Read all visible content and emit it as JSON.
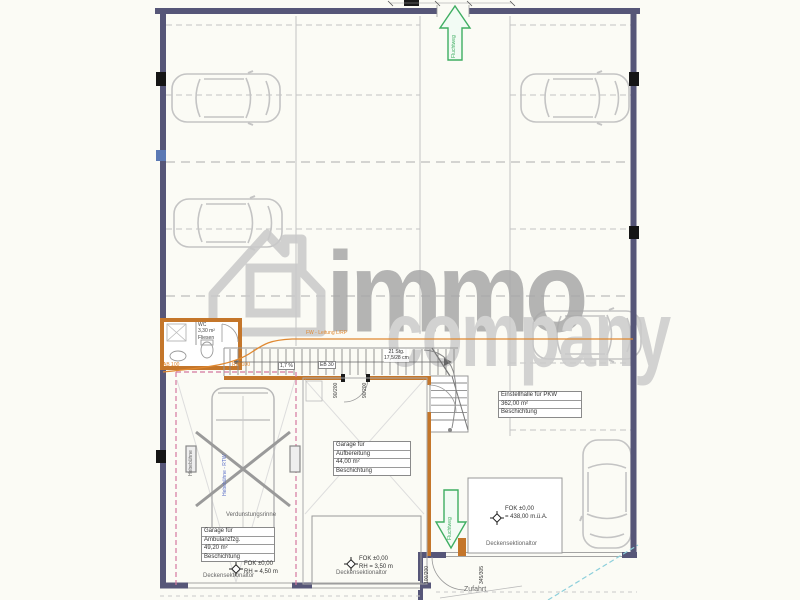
{
  "watermark": {
    "word_top": "immo",
    "word_bottom": "company"
  },
  "rooms": {
    "hall": {
      "l1": "Einstellhalle für PKW",
      "l2": "362,00 m²",
      "l3": "Beschichtung"
    },
    "garage_mid": {
      "l1": "Garage für",
      "l2": "Aufbereitung",
      "l3": "44,00 m²",
      "l4": "Beschichtung"
    },
    "garage_left": {
      "l1": "Garage für",
      "l2": "Ambulanzfzg.",
      "l3": "49,20 m²",
      "l4": "Beschichtung"
    },
    "wc": {
      "l1": "WC",
      "l2": "3,30 m²",
      "l3": "Fliesen"
    }
  },
  "levels": {
    "garage_left": {
      "l1": "FOK ±0,00",
      "l2": "RH = 4,50 m"
    },
    "garage_mid": {
      "l1": "FOK ±0,00",
      "l2": "RH = 3,50 m"
    },
    "hall": {
      "l1": "FOK ±0,00",
      "l2": "= 438,00 m.ü.A."
    }
  },
  "doors": {
    "sectional": "Deckensektionaltor",
    "dim_90a": "90/200",
    "dim_90b": "90/200",
    "dim_100": "100/200",
    "dim_345": "345/305"
  },
  "annotations": {
    "escape": "Fluchtweg",
    "fw_line": "FW - Leitung L/RP",
    "stairs_l1": "21 Stg.",
    "stairs_l2": "17,5/28 cm",
    "eb": "EB 30",
    "slope": "1,7 %",
    "gutter": "Verdunstungsrinne",
    "driveway": "Zufahrt",
    "lift_small": "Hebebühne",
    "lift_vehicle": "Hebebühne - RTW",
    "ab100": "AB 100",
    "rw100": "RW 100"
  },
  "colors": {
    "wall": "#565678",
    "orange_wall": "#c4762a",
    "pipe_orange": "#e08830",
    "escape_green": "#3fae62",
    "survey_cyan": "#8ccfdb",
    "marking_pink": "#d4779f"
  }
}
